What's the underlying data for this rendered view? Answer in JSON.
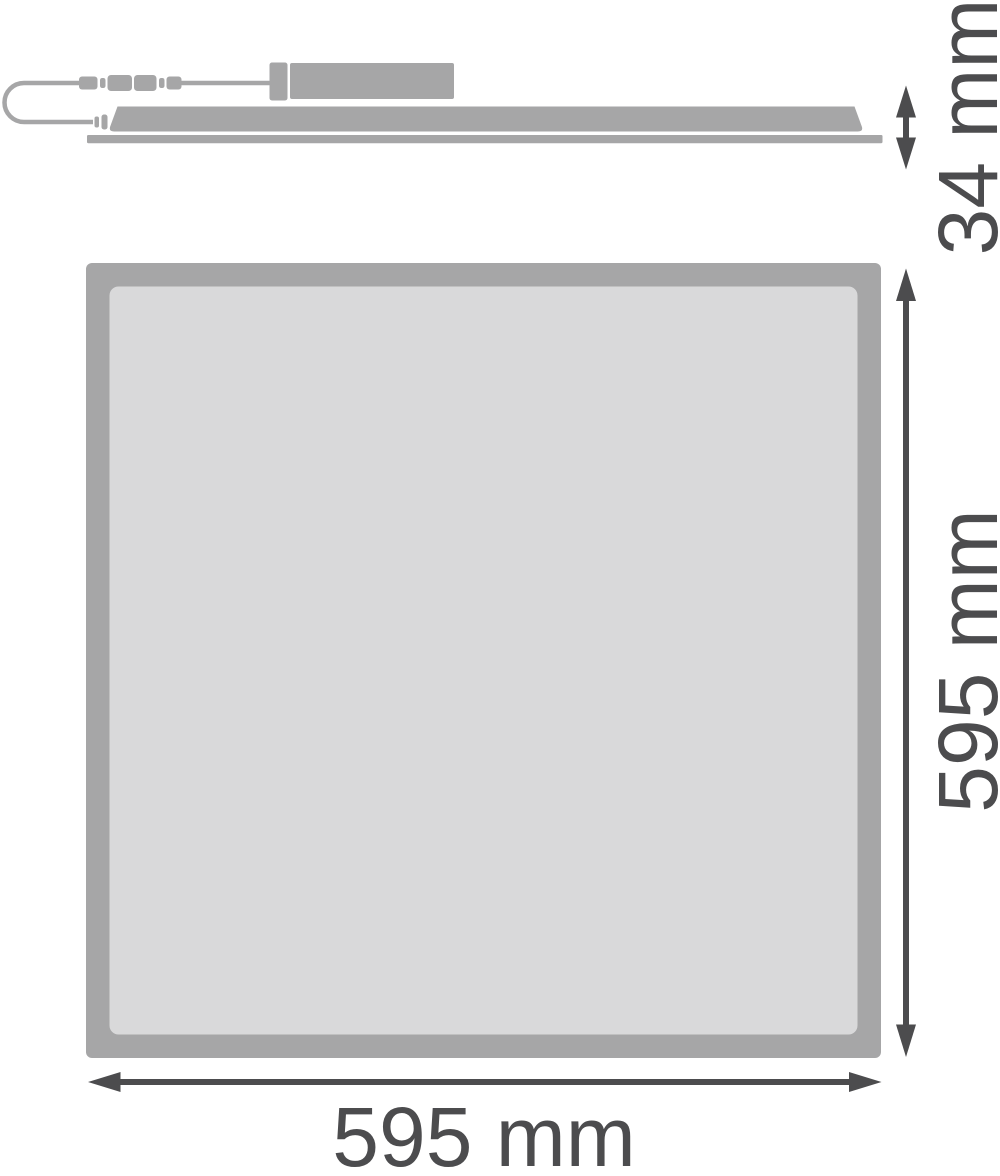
{
  "drawing": {
    "type": "product-dimension-diagram",
    "product": "LED panel luminaire 595x595"
  },
  "side_view": {
    "height_label": "34 mm"
  },
  "front_view": {
    "width_label": "595 mm",
    "height_label": "595 mm"
  },
  "colors": {
    "outline_gray": "#a6a6a7",
    "surface_gray": "#d9d9da",
    "dimension_dark": "#4c4c4e",
    "background": "#ffffff"
  }
}
